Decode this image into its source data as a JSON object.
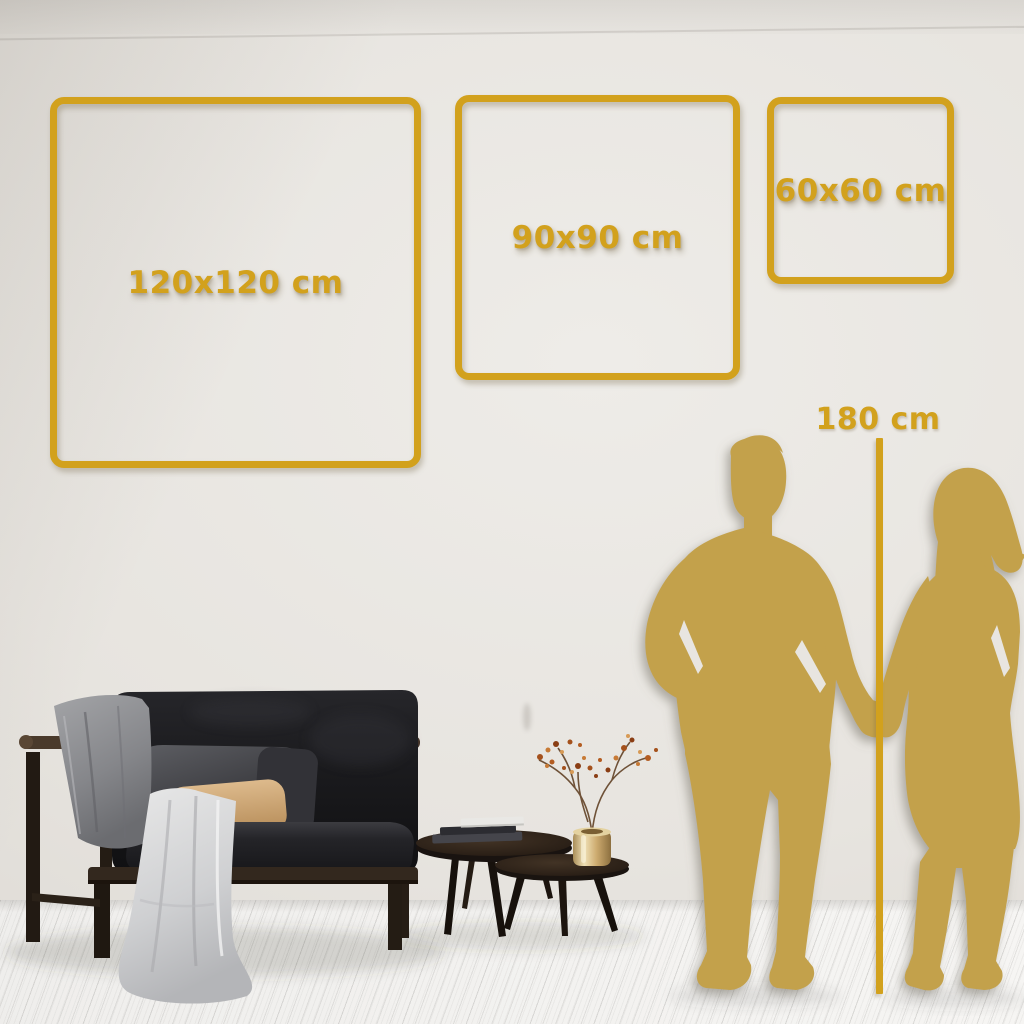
{
  "frames": [
    {
      "id": "large",
      "label": "120x120 cm"
    },
    {
      "id": "medium",
      "label": "90x90 cm"
    },
    {
      "id": "small",
      "label": "60x60 cm"
    }
  ],
  "height_reference": {
    "label": "180 cm"
  },
  "colors": {
    "accent_gold": "#d2a11d",
    "silhouette_gold": "#c3a14c",
    "wall": "#e7e4df",
    "floor": "#f3f2f0"
  },
  "decorative_elements": [
    "couple-silhouette",
    "sofa",
    "throw-blanket",
    "white-drape",
    "beige-pillow",
    "coffee-tables",
    "books",
    "brass-vase",
    "berry-plant"
  ]
}
